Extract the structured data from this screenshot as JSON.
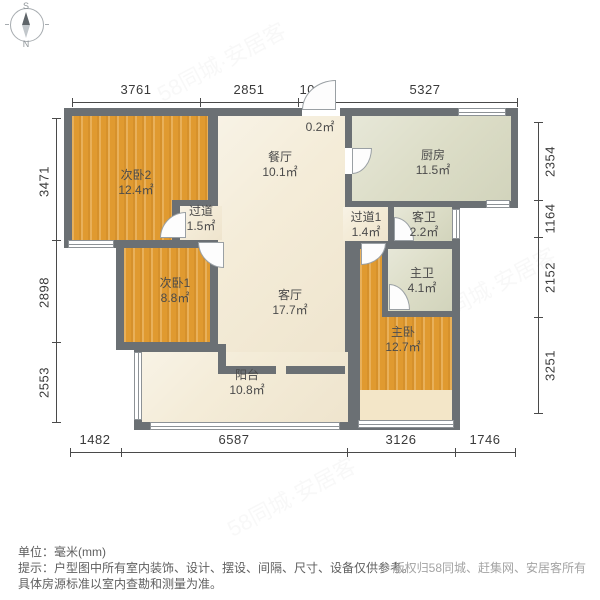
{
  "compass": {
    "south": "S",
    "north": "N"
  },
  "dimensions": {
    "unit": "mm",
    "top": [
      "3761",
      "2851",
      "1003",
      "5327"
    ],
    "left": [
      "3471",
      "2898",
      "2553"
    ],
    "right": [
      "2354",
      "1164",
      "2152",
      "3251"
    ],
    "bottom": [
      "1482",
      "6587",
      "3126",
      "1746"
    ]
  },
  "rooms": {
    "bedroom2": {
      "label": "次卧2",
      "area": "12.4㎡"
    },
    "dining": {
      "label": "餐厅",
      "area": "10.1㎡"
    },
    "entry_niche": {
      "area": "0.2㎡"
    },
    "kitchen": {
      "label": "厨房",
      "area": "11.5㎡"
    },
    "hallway": {
      "label": "过道",
      "area": "1.5㎡"
    },
    "hallway1": {
      "label": "过道1",
      "area": "1.4㎡"
    },
    "guest_bath": {
      "label": "客卫",
      "area": "2.2㎡"
    },
    "bedroom1": {
      "label": "次卧1",
      "area": "8.8㎡"
    },
    "living": {
      "label": "客厅",
      "area": "17.7㎡"
    },
    "master_bath": {
      "label": "主卫",
      "area": "4.1㎡"
    },
    "master_bedroom": {
      "label": "主卧",
      "area": "12.7㎡"
    },
    "balcony": {
      "label": "阳台",
      "area": "10.8㎡"
    }
  },
  "footer": {
    "unit_line": "单位：毫米(mm)",
    "tip_line1": "提示：户型图中所有室内装饰、设计、摆设、间隔、尺寸、设备仅供参考。",
    "tip_line2": "具体房源标准以室内查勘和测量为准。",
    "copyright": "© 版权归58同城、赶集网、安居客所有"
  },
  "watermark_text": "58同城·安居客",
  "colors": {
    "wall": "#6b7074",
    "wood_floor": "#e09a30",
    "cream_floor": "#f4ecd8",
    "tile_floor": "#dcddc7",
    "bay_floor": "#f3e6c8",
    "dimension_text": "#3a3a3a",
    "label_text": "#4b4b4b",
    "copyright_text": "#a3a3a3"
  }
}
